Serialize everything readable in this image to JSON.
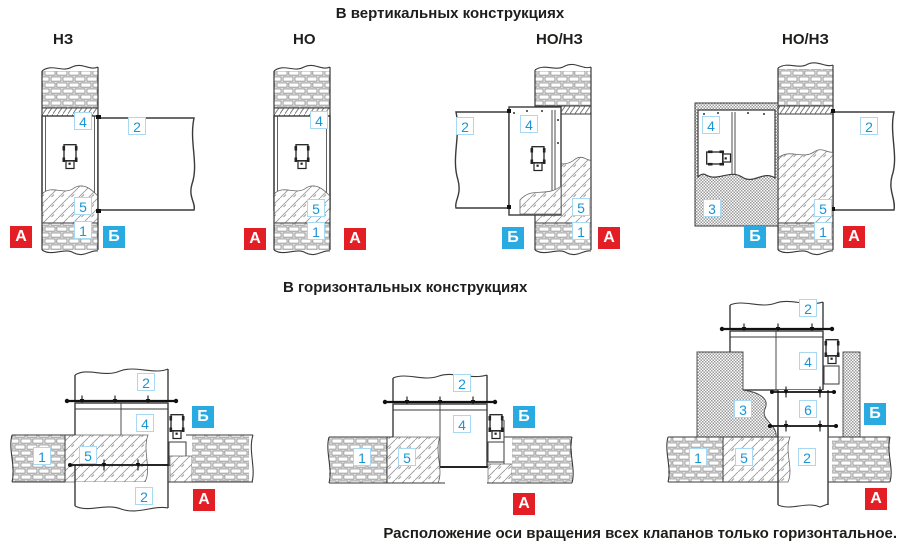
{
  "titles": {
    "vertical_section": "В вертикальных конструкциях",
    "horizontal_section": "В горизонтальных конструкциях",
    "footnote": "Расположение оси вращения всех клапанов только горизонтальное."
  },
  "colors": {
    "marker_red": "#e31e24",
    "marker_blue": "#29abe2",
    "callout_text_blue": "#1a95d5",
    "callout_border_blue": "#a8d9f2",
    "line": "#3a3a3a"
  },
  "figures": {
    "v1": {
      "type_label": "НЗ",
      "callouts": {
        "c4": "4",
        "c2": "2",
        "c5": "5",
        "c1": "1"
      },
      "markers": {
        "left": "А",
        "right": "Б"
      }
    },
    "v2": {
      "type_label": "НО",
      "callouts": {
        "c4": "4",
        "c5": "5",
        "c1": "1"
      },
      "markers": {
        "left": "А",
        "right": "А"
      }
    },
    "v3": {
      "type_label": "НО/НЗ",
      "callouts": {
        "c2": "2",
        "c4": "4",
        "c5": "5",
        "c1": "1"
      },
      "markers": {
        "left": "Б",
        "right": "А"
      }
    },
    "v4": {
      "type_label": "НО/НЗ",
      "callouts": {
        "c4": "4",
        "c2": "2",
        "c3": "3",
        "c5": "5",
        "c1": "1"
      },
      "markers": {
        "left": "Б",
        "right": "А"
      }
    },
    "h1": {
      "callouts": {
        "c2_top": "2",
        "c4": "4",
        "c1": "1",
        "c5": "5",
        "c2_bottom": "2"
      },
      "markers": {
        "top": "Б",
        "bottom": "А"
      }
    },
    "h2": {
      "callouts": {
        "c2": "2",
        "c4": "4",
        "c1": "1",
        "c5": "5"
      },
      "markers": {
        "top": "Б",
        "bottom": "А"
      }
    },
    "h3": {
      "callouts": {
        "c2_top": "2",
        "c4": "4",
        "c3": "3",
        "c6": "6",
        "c1": "1",
        "c5": "5",
        "c2_bottom": "2"
      },
      "markers": {
        "top": "Б",
        "bottom": "А"
      }
    }
  }
}
